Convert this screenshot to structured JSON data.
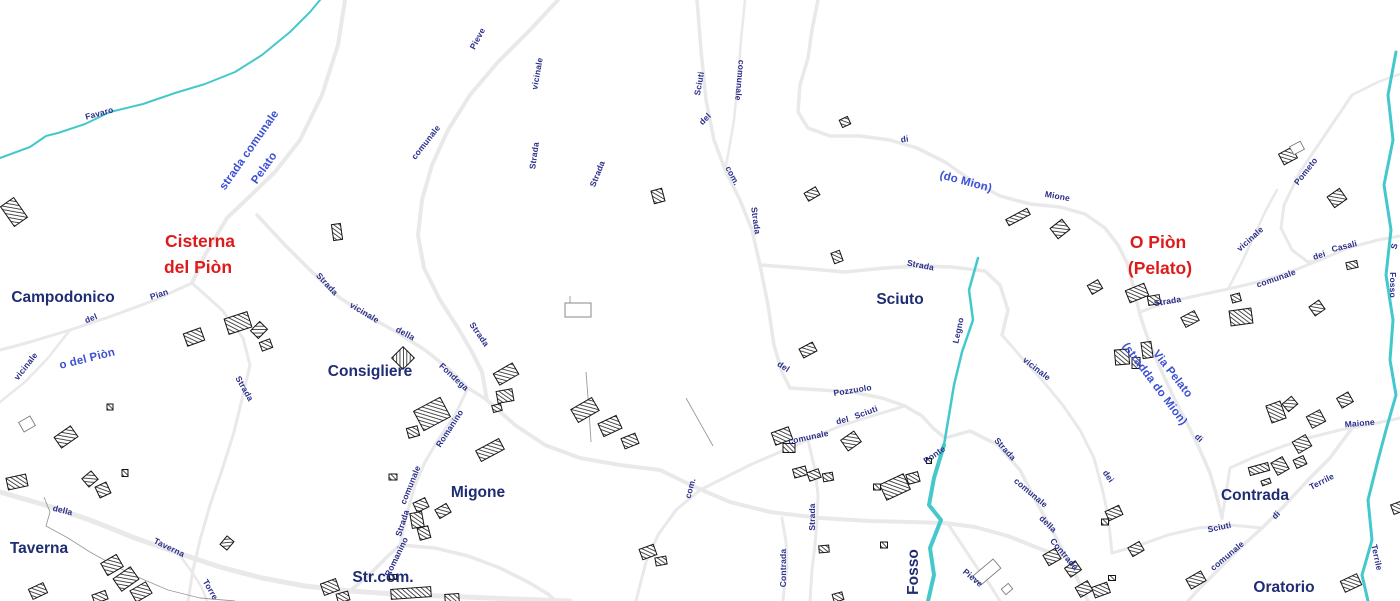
{
  "map": {
    "colors": {
      "road_fill": "#e9e9e9",
      "stream": "#44c8cc",
      "building_outline": "#151515",
      "label_road": "#2b2f8a",
      "label_roadname": "#3b50d4",
      "label_settlement": "#1f2d73",
      "label_red": "#de1b1b"
    },
    "locality_labels_red": [
      "Cisterna del Piòn",
      "O Piòn (Pelato)"
    ],
    "settlement_labels": [
      "Campodonico",
      "Consigliere",
      "Migone",
      "Taverna",
      "Str.com.",
      "Sciuto",
      "Fosso",
      "Contrada",
      "Oratorio"
    ],
    "stream_labels": [
      "Favaro",
      "Legno",
      "Fosso",
      "Terrile"
    ],
    "labels": [
      {
        "text": "Cisterna",
        "x": 200,
        "y": 247,
        "rot": 0,
        "kind": "red"
      },
      {
        "text": "del Piòn",
        "x": 198,
        "y": 273,
        "rot": 0,
        "kind": "red"
      },
      {
        "text": "O Piòn",
        "x": 1158,
        "y": 248,
        "rot": 0,
        "kind": "red"
      },
      {
        "text": "(Pelato)",
        "x": 1160,
        "y": 274,
        "rot": 0,
        "kind": "red"
      },
      {
        "text": "Campodonico",
        "x": 63,
        "y": 302,
        "rot": 0,
        "kind": "settlement"
      },
      {
        "text": "Consigliere",
        "x": 370,
        "y": 376,
        "rot": 0,
        "kind": "settlement"
      },
      {
        "text": "Migone",
        "x": 478,
        "y": 497,
        "rot": 0,
        "kind": "settlement"
      },
      {
        "text": "Taverna",
        "x": 39,
        "y": 553,
        "rot": 0,
        "kind": "settlement"
      },
      {
        "text": "Str.com.",
        "x": 383,
        "y": 582,
        "rot": 0,
        "kind": "settlement"
      },
      {
        "text": "Sciuto",
        "x": 900,
        "y": 304,
        "rot": 0,
        "kind": "settlement"
      },
      {
        "text": "Contrada",
        "x": 1255,
        "y": 500,
        "rot": 0,
        "kind": "settlement"
      },
      {
        "text": "Oratorio",
        "x": 1284,
        "y": 592,
        "rot": 0,
        "kind": "settlement"
      },
      {
        "text": "Fosso",
        "x": 918,
        "y": 572,
        "rot": -90,
        "kind": "settlement"
      },
      {
        "text": "strada comunale",
        "x": 252,
        "y": 152,
        "rot": -55,
        "kind": "roadname"
      },
      {
        "text": "Pelato",
        "x": 267,
        "y": 170,
        "rot": -55,
        "kind": "roadname"
      },
      {
        "text": "o del Piòn",
        "x": 88,
        "y": 362,
        "rot": -14,
        "kind": "roadname"
      },
      {
        "text": "(do Mion)",
        "x": 965,
        "y": 185,
        "rot": 15,
        "kind": "roadname"
      },
      {
        "text": "Via Pelato",
        "x": 1170,
        "y": 376,
        "rot": 52,
        "kind": "roadname"
      },
      {
        "text": "(stradda do Mion)",
        "x": 1152,
        "y": 386,
        "rot": 53,
        "kind": "roadname"
      },
      {
        "text": "Favaro",
        "x": 100,
        "y": 116,
        "rot": -15,
        "kind": "road"
      },
      {
        "text": "Pieve",
        "x": 480,
        "y": 40,
        "rot": -62,
        "kind": "road"
      },
      {
        "text": "vicinale",
        "x": 540,
        "y": 74,
        "rot": -80,
        "kind": "road"
      },
      {
        "text": "comunale",
        "x": 428,
        "y": 144,
        "rot": -52,
        "kind": "road"
      },
      {
        "text": "Strada",
        "x": 537,
        "y": 156,
        "rot": -82,
        "kind": "road"
      },
      {
        "text": "Strada",
        "x": 600,
        "y": 175,
        "rot": -68,
        "kind": "road"
      },
      {
        "text": "Sciuti",
        "x": 702,
        "y": 84,
        "rot": -80,
        "kind": "road"
      },
      {
        "text": "comunale",
        "x": 737,
        "y": 80,
        "rot": 95,
        "kind": "road"
      },
      {
        "text": "del",
        "x": 707,
        "y": 121,
        "rot": -45,
        "kind": "road"
      },
      {
        "text": "com.",
        "x": 730,
        "y": 177,
        "rot": 62,
        "kind": "road"
      },
      {
        "text": "Strada",
        "x": 753,
        "y": 221,
        "rot": 82,
        "kind": "road"
      },
      {
        "text": "di",
        "x": 905,
        "y": 142,
        "rot": -8,
        "kind": "road"
      },
      {
        "text": "Mione",
        "x": 1057,
        "y": 199,
        "rot": 10,
        "kind": "road"
      },
      {
        "text": "Pian",
        "x": 160,
        "y": 297,
        "rot": -18,
        "kind": "road"
      },
      {
        "text": "del",
        "x": 92,
        "y": 321,
        "rot": -22,
        "kind": "road"
      },
      {
        "text": "vicinale",
        "x": 28,
        "y": 368,
        "rot": -52,
        "kind": "road"
      },
      {
        "text": "Strada",
        "x": 242,
        "y": 390,
        "rot": 60,
        "kind": "road"
      },
      {
        "text": "Strada",
        "x": 325,
        "y": 286,
        "rot": 47,
        "kind": "road"
      },
      {
        "text": "vicinale",
        "x": 363,
        "y": 315,
        "rot": 31,
        "kind": "road"
      },
      {
        "text": "della",
        "x": 404,
        "y": 336,
        "rot": 28,
        "kind": "road"
      },
      {
        "text": "Fondega",
        "x": 452,
        "y": 379,
        "rot": 43,
        "kind": "road"
      },
      {
        "text": "Strada",
        "x": 477,
        "y": 336,
        "rot": 55,
        "kind": "road"
      },
      {
        "text": "Romanino",
        "x": 452,
        "y": 430,
        "rot": -57,
        "kind": "road"
      },
      {
        "text": "comunale",
        "x": 413,
        "y": 486,
        "rot": -68,
        "kind": "road"
      },
      {
        "text": "Strada",
        "x": 405,
        "y": 524,
        "rot": -72,
        "kind": "road"
      },
      {
        "text": "Romanino",
        "x": 399,
        "y": 558,
        "rot": -64,
        "kind": "road"
      },
      {
        "text": "della",
        "x": 62,
        "y": 513,
        "rot": 14,
        "kind": "road"
      },
      {
        "text": "Taverna",
        "x": 168,
        "y": 550,
        "rot": 26,
        "kind": "road"
      },
      {
        "text": "Torre",
        "x": 208,
        "y": 591,
        "rot": 60,
        "kind": "road"
      },
      {
        "text": "del",
        "x": 782,
        "y": 369,
        "rot": 33,
        "kind": "road"
      },
      {
        "text": "Pozzuolo",
        "x": 853,
        "y": 393,
        "rot": -9,
        "kind": "road"
      },
      {
        "text": "Sciuti",
        "x": 867,
        "y": 415,
        "rot": -20,
        "kind": "road"
      },
      {
        "text": "del",
        "x": 843,
        "y": 423,
        "rot": -14,
        "kind": "road"
      },
      {
        "text": "comunale",
        "x": 809,
        "y": 440,
        "rot": -12,
        "kind": "road"
      },
      {
        "text": "com.",
        "x": 693,
        "y": 489,
        "rot": -75,
        "kind": "road"
      },
      {
        "text": "Strada",
        "x": 920,
        "y": 268,
        "rot": 11,
        "kind": "road"
      },
      {
        "text": "Legno",
        "x": 961,
        "y": 331,
        "rot": -78,
        "kind": "road"
      },
      {
        "text": "Ponte",
        "x": 936,
        "y": 457,
        "rot": -35,
        "kind": "road"
      },
      {
        "text": "vicinale",
        "x": 1035,
        "y": 371,
        "rot": 38,
        "kind": "road"
      },
      {
        "text": "Strada",
        "x": 1003,
        "y": 451,
        "rot": 48,
        "kind": "road"
      },
      {
        "text": "comunale",
        "x": 1029,
        "y": 495,
        "rot": 40,
        "kind": "road"
      },
      {
        "text": "della",
        "x": 1046,
        "y": 526,
        "rot": 44,
        "kind": "road"
      },
      {
        "text": "Contrada",
        "x": 1062,
        "y": 556,
        "rot": 50,
        "kind": "road"
      },
      {
        "text": "dei",
        "x": 1106,
        "y": 478,
        "rot": 55,
        "kind": "road"
      },
      {
        "text": "di",
        "x": 1197,
        "y": 440,
        "rot": 45,
        "kind": "road"
      },
      {
        "text": "Strada",
        "x": 1168,
        "y": 304,
        "rot": -9,
        "kind": "road"
      },
      {
        "text": "comunale",
        "x": 1277,
        "y": 281,
        "rot": -19,
        "kind": "road"
      },
      {
        "text": "dei",
        "x": 1320,
        "y": 258,
        "rot": -18,
        "kind": "road"
      },
      {
        "text": "Casali",
        "x": 1345,
        "y": 249,
        "rot": -14,
        "kind": "road"
      },
      {
        "text": "vicinale",
        "x": 1252,
        "y": 241,
        "rot": -42,
        "kind": "road"
      },
      {
        "text": "Pometo",
        "x": 1308,
        "y": 173,
        "rot": -52,
        "kind": "road"
      },
      {
        "text": "Fosso",
        "x": 1390,
        "y": 285,
        "rot": 90,
        "kind": "road"
      },
      {
        "text": "Maione",
        "x": 1360,
        "y": 426,
        "rot": -5,
        "kind": "road"
      },
      {
        "text": "Terrile",
        "x": 1323,
        "y": 484,
        "rot": -27,
        "kind": "road"
      },
      {
        "text": "di",
        "x": 1278,
        "y": 517,
        "rot": -45,
        "kind": "road"
      },
      {
        "text": "Sciuti",
        "x": 1220,
        "y": 530,
        "rot": -12,
        "kind": "road"
      },
      {
        "text": "comunale",
        "x": 1229,
        "y": 558,
        "rot": -40,
        "kind": "road"
      },
      {
        "text": "Terrile",
        "x": 1374,
        "y": 558,
        "rot": 78,
        "kind": "road"
      },
      {
        "text": "Strada",
        "x": 815,
        "y": 517,
        "rot": -90,
        "kind": "road"
      },
      {
        "text": "Contrada",
        "x": 786,
        "y": 568,
        "rot": -90,
        "kind": "road"
      },
      {
        "text": "Pieve",
        "x": 971,
        "y": 580,
        "rot": 40,
        "kind": "road"
      },
      {
        "text": "S",
        "x": 1397,
        "y": 247,
        "rot": -75,
        "kind": "road"
      }
    ]
  }
}
